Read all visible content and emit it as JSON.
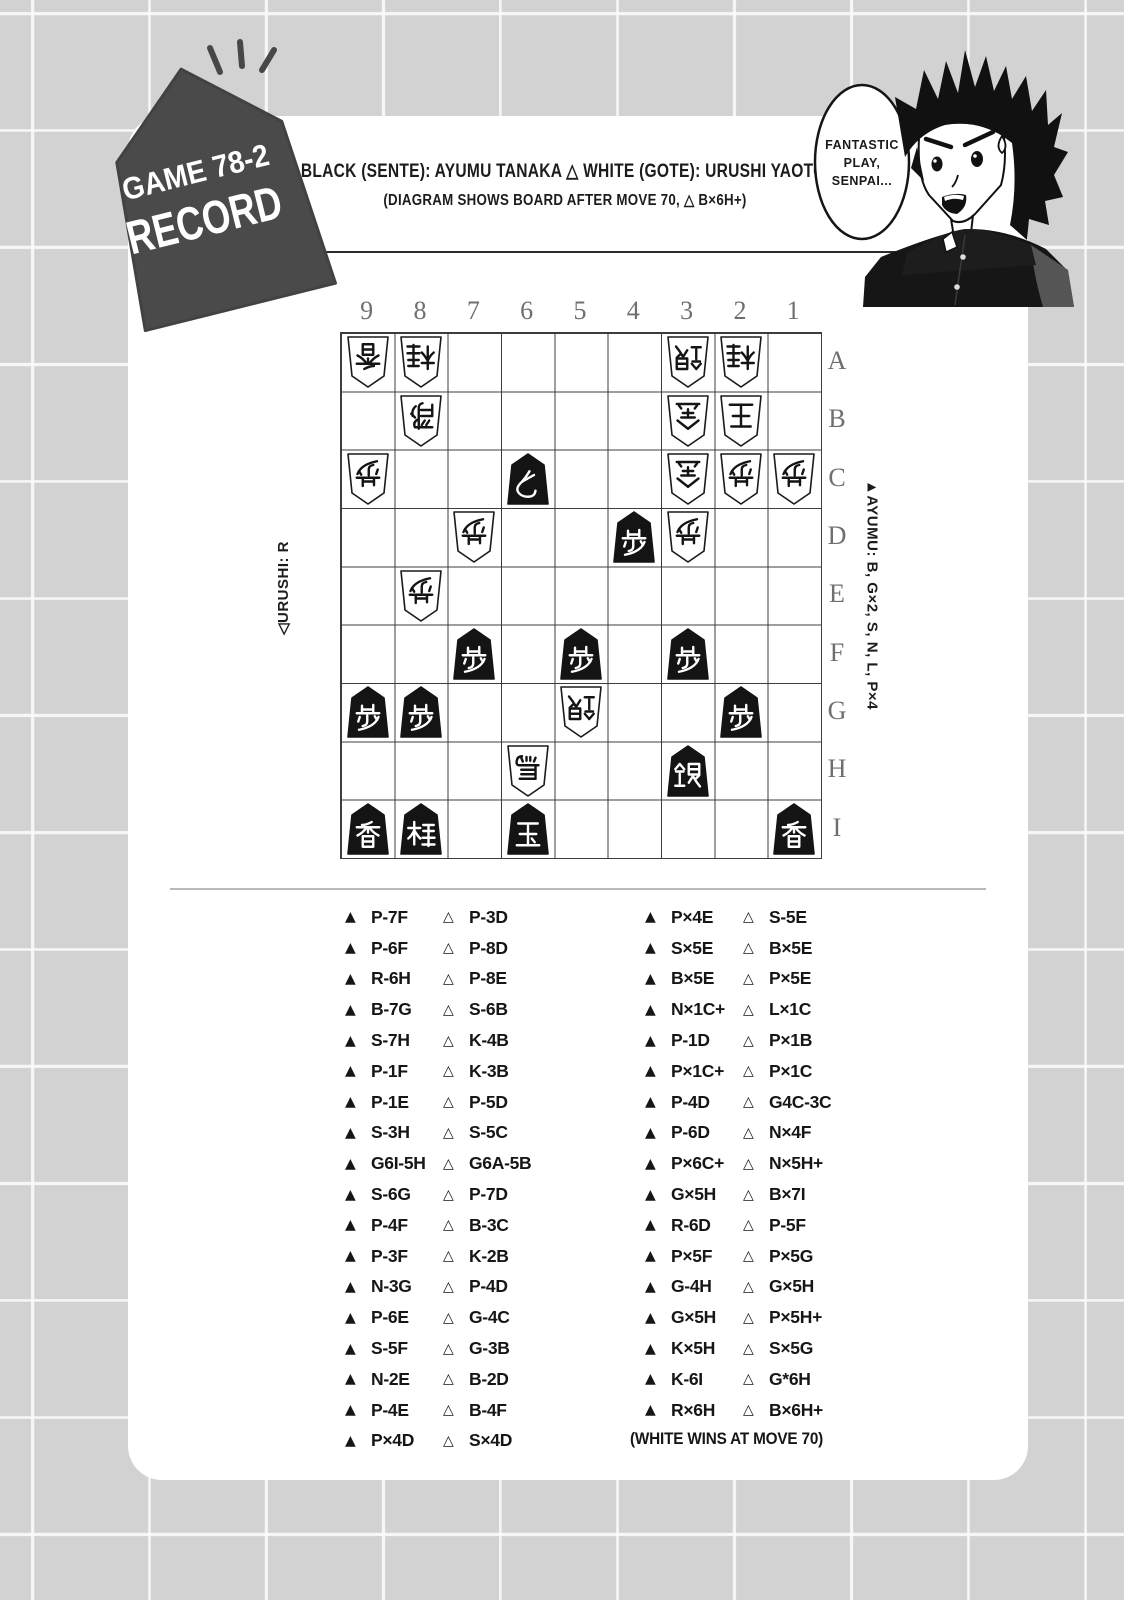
{
  "page": {
    "background": "#d2d2d2",
    "grid_line": "#fafafa",
    "card_color": "#ffffff"
  },
  "tag": {
    "line1": "GAME 78-2",
    "line2": "RECORD",
    "bg": "#4a4a4a",
    "text_color": "#ffffff"
  },
  "header": {
    "players_line": "▲ BLACK (SENTE): AYUMU TANAKA  △ WHITE (GOTE): URUSHI YAOTOME",
    "diagram_note": "(DIAGRAM SHOWS BOARD AFTER MOVE 70, △ B×6H+)"
  },
  "speech_bubble": {
    "lines": [
      "FANTASTIC",
      "PLAY,",
      "SENPAI..."
    ]
  },
  "symbols": {
    "black_move_marker": "▲",
    "white_move_marker": "△",
    "white_player_marker": "◁",
    "black_player_marker": "▲"
  },
  "board": {
    "files": [
      "9",
      "8",
      "7",
      "6",
      "5",
      "4",
      "3",
      "2",
      "1"
    ],
    "ranks": [
      "A",
      "B",
      "C",
      "D",
      "E",
      "F",
      "G",
      "H",
      "I"
    ],
    "white_hand_label": "◁URUSHI: R",
    "black_hand_label": "▲AYUMU: B, G×2, S, N, L, P×4",
    "pieces": [
      {
        "square": "9A",
        "name": "lance",
        "kanji": "香",
        "side": "white"
      },
      {
        "square": "8A",
        "name": "knight",
        "kanji": "桂",
        "side": "white"
      },
      {
        "square": "3A",
        "name": "silver",
        "kanji": "銀",
        "side": "white"
      },
      {
        "square": "2A",
        "name": "knight",
        "kanji": "桂",
        "side": "white"
      },
      {
        "square": "8B",
        "name": "rook",
        "kanji": "飛",
        "side": "white"
      },
      {
        "square": "3B",
        "name": "gold",
        "kanji": "金",
        "side": "white"
      },
      {
        "square": "2B",
        "name": "king",
        "kanji": "王",
        "side": "white"
      },
      {
        "square": "9C",
        "name": "pawn",
        "kanji": "歩",
        "side": "white"
      },
      {
        "square": "6C",
        "name": "tokin",
        "kanji": "と",
        "side": "black"
      },
      {
        "square": "3C",
        "name": "gold",
        "kanji": "金",
        "side": "white"
      },
      {
        "square": "2C",
        "name": "pawn",
        "kanji": "歩",
        "side": "white"
      },
      {
        "square": "1C",
        "name": "pawn",
        "kanji": "歩",
        "side": "white"
      },
      {
        "square": "7D",
        "name": "pawn",
        "kanji": "歩",
        "side": "white"
      },
      {
        "square": "4D",
        "name": "pawn",
        "kanji": "歩",
        "side": "black"
      },
      {
        "square": "3D",
        "name": "pawn",
        "kanji": "歩",
        "side": "white"
      },
      {
        "square": "8E",
        "name": "pawn",
        "kanji": "歩",
        "side": "white"
      },
      {
        "square": "7F",
        "name": "pawn",
        "kanji": "歩",
        "side": "black"
      },
      {
        "square": "5F",
        "name": "pawn",
        "kanji": "歩",
        "side": "black"
      },
      {
        "square": "3F",
        "name": "pawn",
        "kanji": "歩",
        "side": "black"
      },
      {
        "square": "9G",
        "name": "pawn",
        "kanji": "歩",
        "side": "black"
      },
      {
        "square": "8G",
        "name": "pawn",
        "kanji": "歩",
        "side": "black"
      },
      {
        "square": "5G",
        "name": "silver",
        "kanji": "銀",
        "side": "white"
      },
      {
        "square": "2G",
        "name": "pawn",
        "kanji": "歩",
        "side": "black"
      },
      {
        "square": "6H",
        "name": "promoted-bishop",
        "kanji": "馬",
        "side": "white"
      },
      {
        "square": "3H",
        "name": "silver",
        "kanji": "銀",
        "side": "black"
      },
      {
        "square": "9I",
        "name": "lance",
        "kanji": "香",
        "side": "black"
      },
      {
        "square": "8I",
        "name": "knight",
        "kanji": "桂",
        "side": "black"
      },
      {
        "square": "6I",
        "name": "king",
        "kanji": "玉",
        "side": "black"
      },
      {
        "square": "1I",
        "name": "lance",
        "kanji": "香",
        "side": "black"
      }
    ]
  },
  "moves": {
    "column1": [
      {
        "black": "P-7F",
        "white": "P-3D"
      },
      {
        "black": "P-6F",
        "white": "P-8D"
      },
      {
        "black": "R-6H",
        "white": "P-8E"
      },
      {
        "black": "B-7G",
        "white": "S-6B"
      },
      {
        "black": "S-7H",
        "white": "K-4B"
      },
      {
        "black": "P-1F",
        "white": "K-3B"
      },
      {
        "black": "P-1E",
        "white": "P-5D"
      },
      {
        "black": "S-3H",
        "white": "S-5C"
      },
      {
        "black": "G6I-5H",
        "white": "G6A-5B"
      },
      {
        "black": "S-6G",
        "white": "P-7D"
      },
      {
        "black": "P-4F",
        "white": "B-3C"
      },
      {
        "black": "P-3F",
        "white": "K-2B"
      },
      {
        "black": "N-3G",
        "white": "P-4D"
      },
      {
        "black": "P-6E",
        "white": "G-4C"
      },
      {
        "black": "S-5F",
        "white": "G-3B"
      },
      {
        "black": "N-2E",
        "white": "B-2D"
      },
      {
        "black": "P-4E",
        "white": "B-4F"
      },
      {
        "black": "P×4D",
        "white": "S×4D"
      }
    ],
    "column2": [
      {
        "black": "P×4E",
        "white": "S-5E"
      },
      {
        "black": "S×5E",
        "white": "B×5E"
      },
      {
        "black": "B×5E",
        "white": "P×5E"
      },
      {
        "black": "N×1C+",
        "white": "L×1C"
      },
      {
        "black": "P-1D",
        "white": "P×1B"
      },
      {
        "black": "P×1C+",
        "white": "P×1C"
      },
      {
        "black": "P-4D",
        "white": "G4C-3C"
      },
      {
        "black": "P-6D",
        "white": "N×4F"
      },
      {
        "black": "P×6C+",
        "white": "N×5H+"
      },
      {
        "black": "G×5H",
        "white": "B×7I"
      },
      {
        "black": "R-6D",
        "white": "P-5F"
      },
      {
        "black": "P×5F",
        "white": "P×5G"
      },
      {
        "black": "G-4H",
        "white": "G×5H"
      },
      {
        "black": "G×5H",
        "white": "P×5H+"
      },
      {
        "black": "K×5H",
        "white": "S×5G"
      },
      {
        "black": "K-6I",
        "white": "G*6H"
      },
      {
        "black": "R×6H",
        "white": "B×6H+"
      }
    ],
    "result": "(WHITE WINS AT MOVE 70)"
  }
}
